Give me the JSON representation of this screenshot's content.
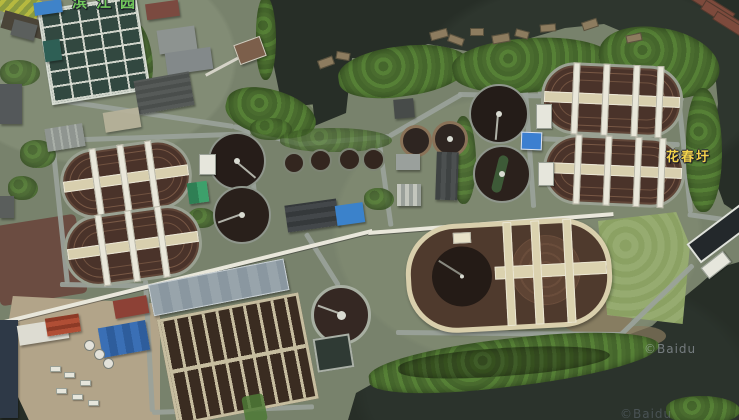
{
  "map": {
    "view": "satellite",
    "watermark": "©Baidu",
    "watermark_bottom": "©Baidu",
    "labels": {
      "place_right": "花春圩",
      "place_top_partial": "滨江园"
    },
    "colors": {
      "water": "#272e27",
      "land": "#78826c",
      "road": "#9aa29a",
      "tree_dark": "#45662c",
      "tree_bright": "#568036",
      "basin_brown": "#4a332a",
      "clarifier_dark": "#261d19",
      "platform_cream": "#d9cfac",
      "roof_blue": "#3f83c9",
      "label_yellow": "#f3d34a",
      "label_green": "#72c75b"
    },
    "feature_names": [
      "sewage-treatment-plant",
      "river",
      "rectangular-filter-grid",
      "oxidation-ditches",
      "circular-clarifiers",
      "sludge-digesters",
      "aeration-basin-complex",
      "twin-clarifier-platform",
      "pier",
      "barges",
      "industrial-yard"
    ]
  }
}
